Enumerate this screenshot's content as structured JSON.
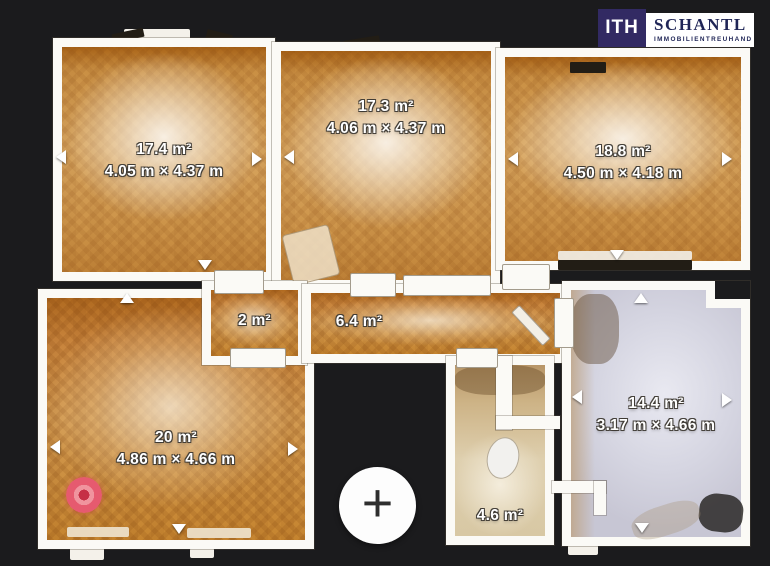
{
  "brand": {
    "logo_text": "ITH",
    "name": "SCHANTL",
    "tagline": "IMMOBILIENTREUHAND",
    "logo_bg_color": "#322a63",
    "logo_text_color": "#1f2556"
  },
  "rooms": [
    {
      "id": "room-17-4",
      "area": "17.4 m²",
      "dims": "4.05 m × 4.37 m"
    },
    {
      "id": "room-17-3",
      "area": "17.3 m²",
      "dims": "4.06 m × 4.37 m"
    },
    {
      "id": "room-18-8",
      "area": "18.8 m²",
      "dims": "4.50 m × 4.18 m"
    },
    {
      "id": "room-2",
      "area": "2 m²",
      "dims": ""
    },
    {
      "id": "room-6-4",
      "area": "6.4 m²",
      "dims": ""
    },
    {
      "id": "room-20",
      "area": "20 m²",
      "dims": "4.86 m × 4.66 m"
    },
    {
      "id": "room-4-6",
      "area": "4.6 m²",
      "dims": ""
    },
    {
      "id": "room-14-4",
      "area": "14.4 m²",
      "dims": "3.17 m × 4.66 m"
    }
  ],
  "controls": {
    "add_button_glyph": "+"
  },
  "markers": {
    "camera_marker_color": "#e65a6f"
  },
  "colors": {
    "background": "#1b1b1d",
    "wall": "#fbfaf6",
    "wood_floor": "#d8a660",
    "light_floor": "#d6d6e2"
  }
}
